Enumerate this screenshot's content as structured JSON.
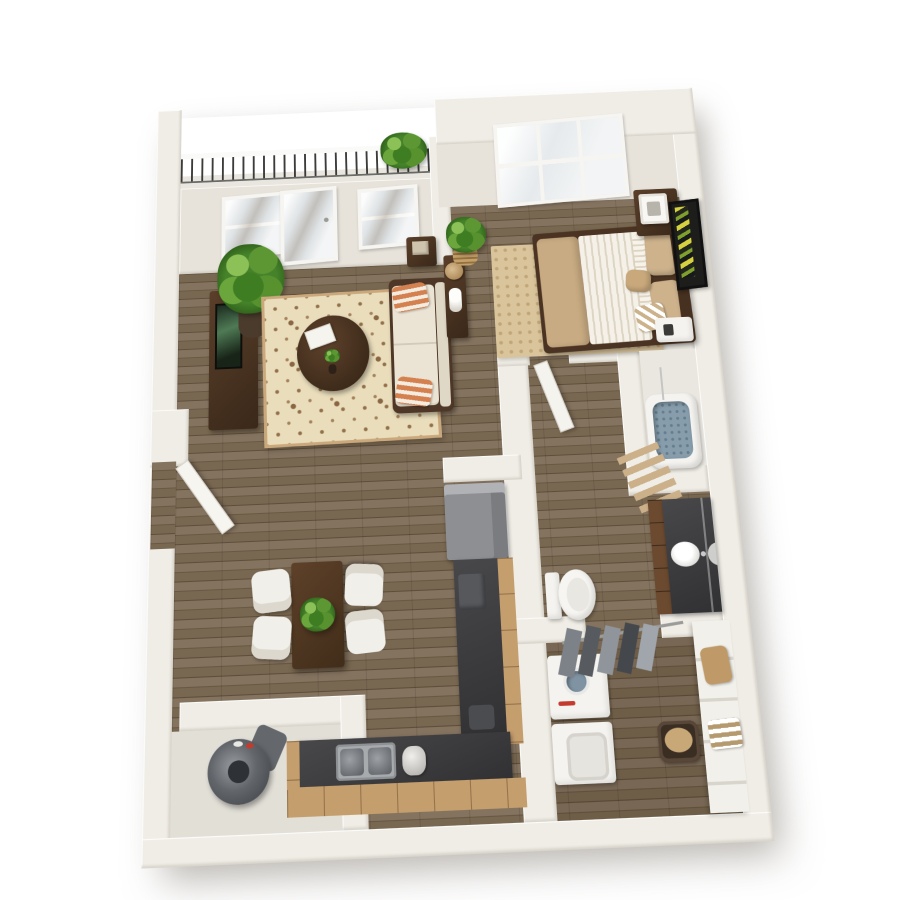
{
  "scene": {
    "title": "One-bedroom apartment 3D floor plan",
    "description": "Top-down 3D dollhouse rendering of a one-bedroom apartment with balcony, open living/dining area, kitchen, bedroom, bathroom, laundry closet and utility closet",
    "view": "isometric top-down with slight perspective",
    "background_color": "#ffffff"
  },
  "palette": {
    "wall": "#f0ede6",
    "wall_shade": "#e7e3db",
    "wood_floor": "#7d6c58",
    "wood_floor_dark": "#5f4e3b",
    "balcony_floor": "#e9e6df",
    "rug_living_base": "#e9ddbb",
    "rug_living_pattern": "#93704a",
    "rug_bedroom": "#d9c49c",
    "sofa_cream": "#ebe4d4",
    "pillow_orange": "#d5804f",
    "dark_wood": "#4a3423",
    "bedding_white": "#f3efe6",
    "bedding_tan": "#c8ab82",
    "countertop_charcoal": "#3e3e40",
    "cabinet_tan": "#c59e6e",
    "appliance_grey": "#8d8f92",
    "fixture_white": "#f4f3ef",
    "tub_water_blue": "#879dac",
    "plant_green": "#4e8a28",
    "towel_tan": "#cbb089",
    "accent_red": "#c43b2e"
  },
  "rooms": [
    {
      "name": "Balcony",
      "furniture": [
        "metal railing with white handrail",
        "potted plant on railing corner"
      ]
    },
    {
      "name": "Living room",
      "furniture": [
        "French glass door",
        "two balcony windows",
        "tall potted plant",
        "media console with TV",
        "damask area rug",
        "oval espresso coffee table with magazine and vase",
        "cream loveseat with two orange striped pillows",
        "sofa console table with woven lamp and white vases",
        "dark side table with beige box",
        "plant in woven basket"
      ]
    },
    {
      "name": "Dining area",
      "furniture": [
        "rectangular dark wood dining table",
        "four white chairs",
        "green plant centerpiece"
      ]
    },
    {
      "name": "Kitchen",
      "furniture": [
        "grey refrigerator",
        "L-shaped charcoal counter with tan cabinets",
        "stainless double-bowl sink",
        "kettle",
        "dark countertop appliance",
        "toaster"
      ]
    },
    {
      "name": "Bedroom",
      "furniture": [
        "six-pane window",
        "queen bed with white striped duvet and tan blanket",
        "tan and white pillows with chevron accent pillow",
        "dark wood headboard",
        "dotted tan area rug",
        "nightstand with white cube lamp",
        "second white nightstand",
        "framed abstract wall art"
      ]
    },
    {
      "name": "Bathroom",
      "furniture": [
        "bathtub with water",
        "shower curtain rod",
        "tan towel ladder",
        "toilet",
        "vanity with brown drawers and charcoal counter",
        "white vessel sink with faucet",
        "wall mirror"
      ]
    },
    {
      "name": "Laundry closet",
      "furniture": [
        "washer with dial and red button",
        "dryer",
        "clothes rod with five hanging garments",
        "red striped garment",
        "laundry basket with tan cloth",
        "white shelving unit with tan bag and striped towels"
      ]
    },
    {
      "name": "Utility closet",
      "furniture": [
        "cylindrical water heater"
      ]
    },
    {
      "name": "Entry",
      "furniture": [
        "open white entry door"
      ]
    },
    {
      "name": "Hallway",
      "furniture": [
        "open white bathroom door"
      ]
    }
  ]
}
